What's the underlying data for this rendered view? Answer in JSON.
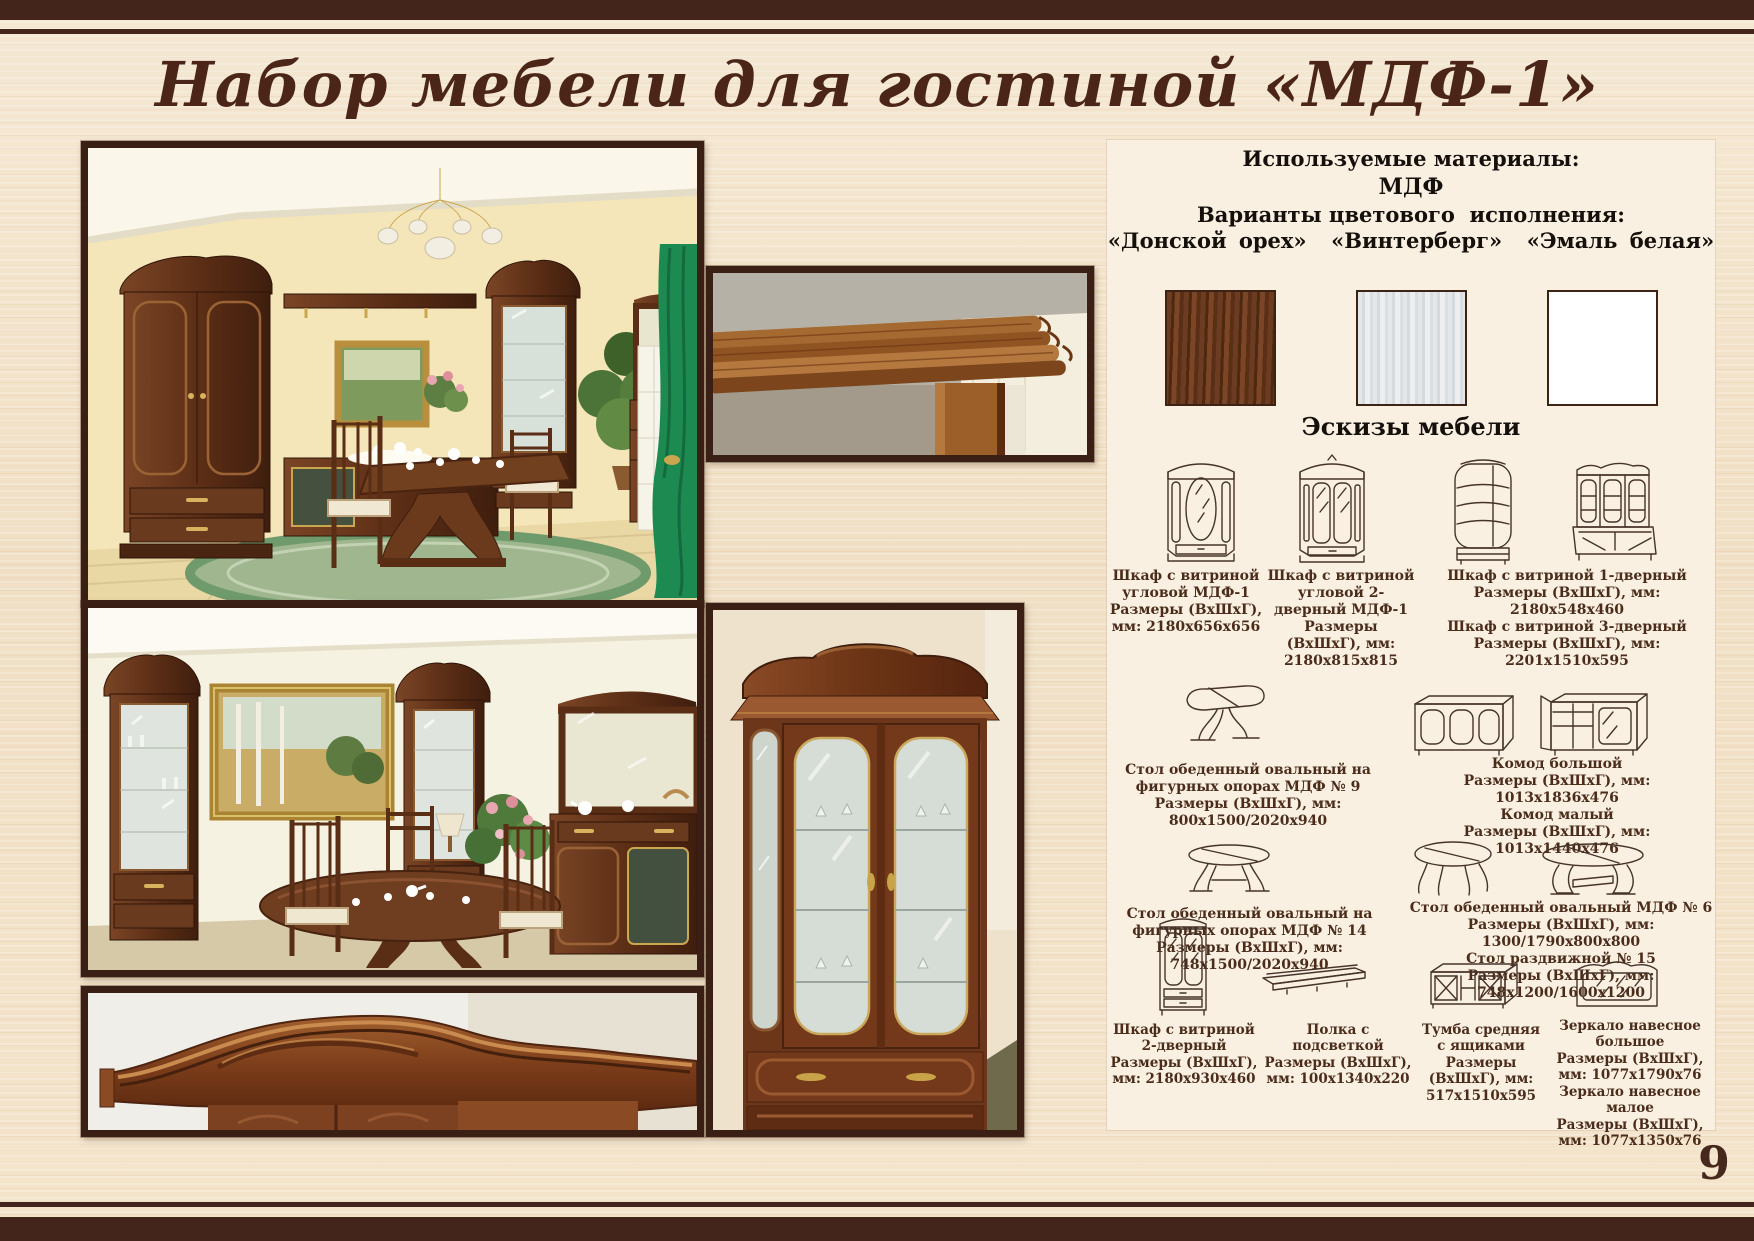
{
  "page": {
    "title": "Набор мебели для гостиной «МДФ-1»",
    "page_number": "9"
  },
  "colors": {
    "accent_dark_brown": "#44251c",
    "panel_background": "#f9f0e2",
    "caption_text": "#4b2c1a",
    "walnut_swatch": "#5e3420",
    "winterberg_swatch": "#dde0e2",
    "white_enamel_swatch": "#ffffff"
  },
  "materials": {
    "heading": "Используемые материалы:",
    "material": "МДФ",
    "variants_heading": "Варианты цветового  исполнения:",
    "variants_line": "«Донской орех»  «Винтерберг»  «Эмаль белая»",
    "swatches": [
      {
        "name": "Донской орех",
        "color": "#5e3420"
      },
      {
        "name": "Винтерберг",
        "color": "#dde0e2"
      },
      {
        "name": "Эмаль белая",
        "color": "#ffffff"
      }
    ]
  },
  "sketches": {
    "heading": "Эскизы мебели",
    "captions": [
      {
        "name": "Шкаф с витриной угловой МДФ-1",
        "size": "Размеры (ВхШхГ), мм: 2180х656х656"
      },
      {
        "name": "Шкаф с витриной угловой 2-дверный МДФ-1",
        "size": "Размеры (ВхШхГ), мм: 2180х815х815"
      },
      {
        "name": "Шкаф с витриной 1-дверный",
        "size": "Размеры (ВхШхГ), мм: 2180х548х460"
      },
      {
        "name": "Шкаф с витриной 3-дверный",
        "size": "Размеры (ВхШхГ), мм: 2201х1510х595"
      },
      {
        "name": "Стол обеденный овальный на фигурных опорах МДФ № 9",
        "size": "Размеры (ВхШхГ), мм: 800х1500/2020х940"
      },
      {
        "name": "Комод большой",
        "size": "Размеры (ВхШхГ), мм: 1013х1836х476"
      },
      {
        "name": "Комод малый",
        "size": "Размеры (ВхШхГ), мм: 1013х1440х476"
      },
      {
        "name": "Стол обеденный овальный на фигурных опорах МДФ № 14",
        "size": "Размеры (ВхШхГ), мм: 748х1500/2020х940"
      },
      {
        "name": "Стол обеденный овальный МДФ № 6",
        "size": "Размеры (ВхШхГ), мм: 1300/1790х800х800"
      },
      {
        "name": "Стол раздвижной № 15",
        "size": "Размеры (ВхШхГ), мм: 748х1200/1600х1200"
      },
      {
        "name": "Шкаф с витриной 2-дверный",
        "size": "Размеры (ВхШхГ), мм: 2180х930х460"
      },
      {
        "name": "Полка с подсветкой",
        "size": "Размеры (ВхШхГ), мм: 100х1340х220"
      },
      {
        "name": "Тумба средняя с ящиками",
        "size": "Размеры (ВхШхГ), мм: 517х1510х595"
      },
      {
        "name": "Зеркало навесное большое",
        "size": "Размеры (ВхШхГ), мм: 1077х1790х76"
      },
      {
        "name": "Зеркало навесное малое",
        "size": "Размеры (ВхШхГ), мм: 1077х1350х76"
      }
    ]
  }
}
